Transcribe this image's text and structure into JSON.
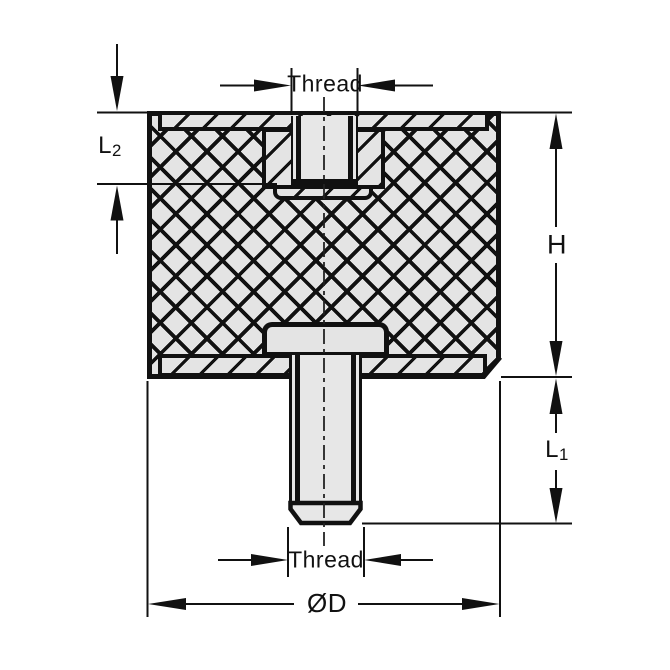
{
  "drawing": {
    "description": "Cross-section of cylindrical rubber vibration mount, female thread on top, male stud on bottom",
    "labels": {
      "thread_top": "Thread",
      "thread_bottom": "Thread",
      "height": "H",
      "diameter": "ØD",
      "l1": {
        "main": "L",
        "sub": "1"
      },
      "l2": {
        "main": "L",
        "sub": "2"
      }
    },
    "colors": {
      "line": "#111111",
      "fill_light": "#e4e4e4",
      "fill_bore": "#e7e7e7",
      "background": "#ffffff"
    }
  }
}
